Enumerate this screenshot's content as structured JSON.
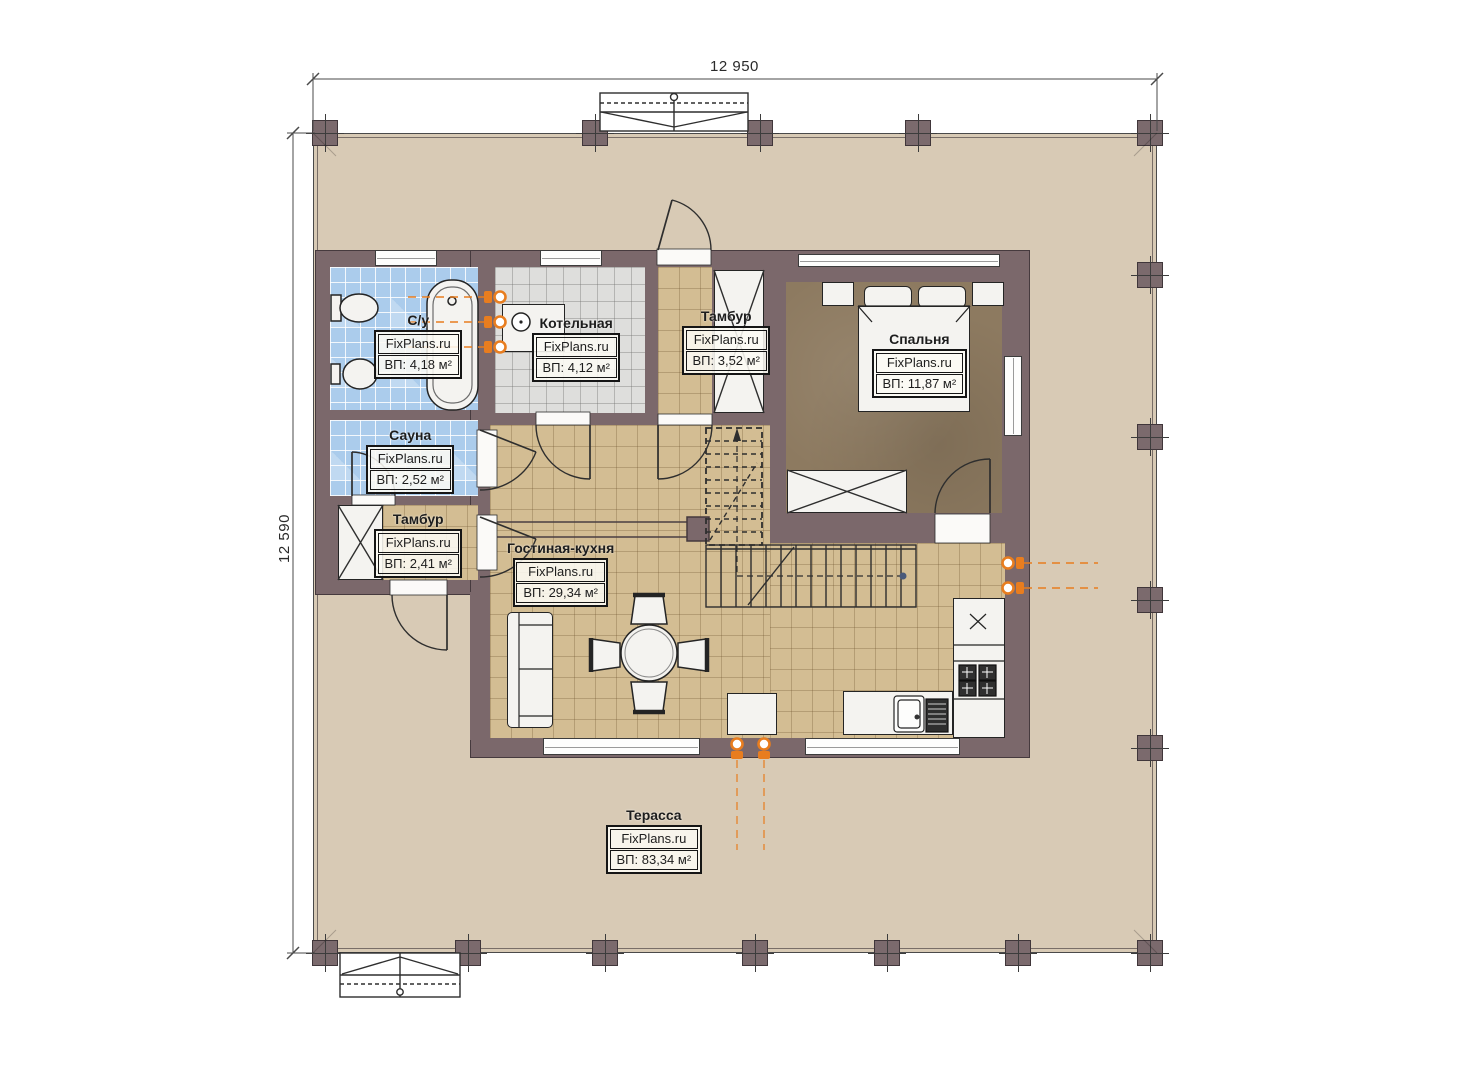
{
  "plan": {
    "dimensions": {
      "top": "12 950",
      "left": "12 590"
    },
    "rooms": [
      {
        "name": "С/у",
        "brand": "FixPlans.ru",
        "area": "ВП: 4,18 м²"
      },
      {
        "name": "Котельная",
        "brand": "FixPlans.ru",
        "area": "ВП: 4,12 м²"
      },
      {
        "name": "Тамбур",
        "brand": "FixPlans.ru",
        "area": "ВП: 3,52 м²"
      },
      {
        "name": "Спальня",
        "brand": "FixPlans.ru",
        "area": "ВП: 11,87 м²"
      },
      {
        "name": "Сауна",
        "brand": "FixPlans.ru",
        "area": "ВП: 2,52 м²"
      },
      {
        "name": "Тамбур",
        "brand": "FixPlans.ru",
        "area": "ВП: 2,41 м²"
      },
      {
        "name": "Гостиная-кухня",
        "brand": "FixPlans.ru",
        "area": "ВП: 29,34 м²"
      },
      {
        "name": "Терасса",
        "brand": "FixPlans.ru",
        "area": "ВП: 83,34 м²"
      }
    ],
    "colors": {
      "wall": "#7b686b",
      "terrace": "#d8cab5",
      "floor_tan": "#d3bd93",
      "floor_blue": "#abccec",
      "floor_gray": "#dededc",
      "floor_bedroom": "#8d7a60",
      "radiator": "#e87d1f",
      "line": "#2e2e2e"
    }
  }
}
